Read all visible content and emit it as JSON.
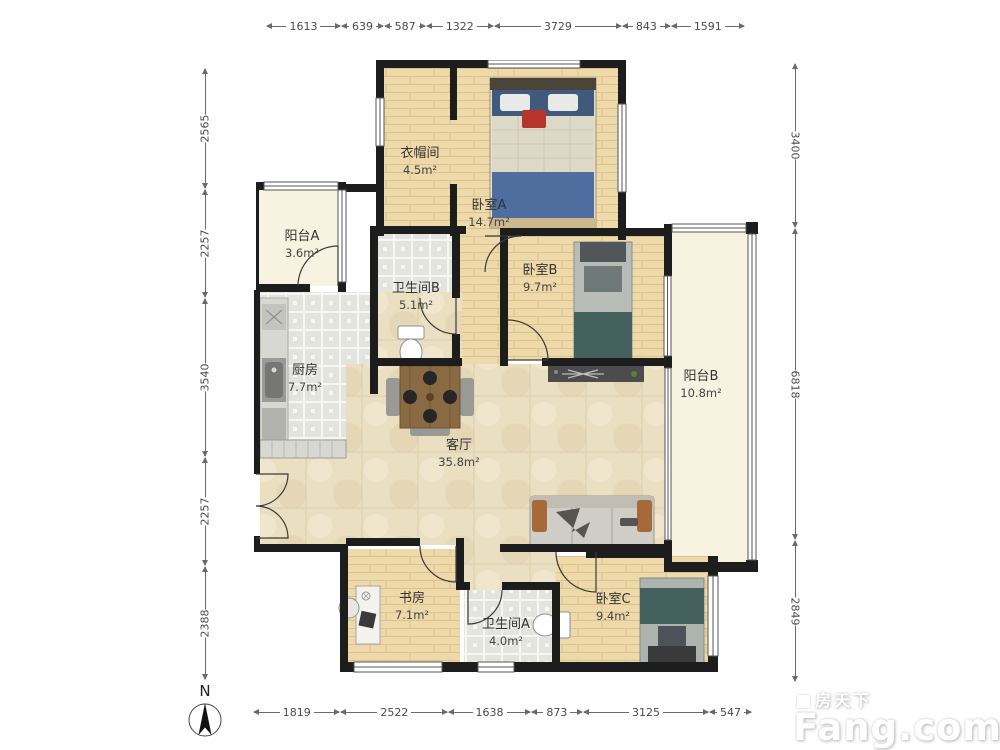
{
  "dims": {
    "top": [
      "1613",
      "639",
      "587",
      "1322",
      "3729",
      "843",
      "1591"
    ],
    "bottom": [
      "1819",
      "2522",
      "1638",
      "873",
      "3125",
      "547"
    ],
    "left": [
      "2565",
      "2257",
      "3540",
      "2257",
      "2388"
    ],
    "right": [
      "3400",
      "6818",
      "2849"
    ]
  },
  "rooms": {
    "cloakroom": {
      "name": "衣帽间",
      "area": "4.5m²"
    },
    "bedroomA": {
      "name": "卧室A",
      "area": "14.7m²"
    },
    "balconyA": {
      "name": "阳台A",
      "area": "3.6m²"
    },
    "bathroomB": {
      "name": "卫生间B",
      "area": "5.1m²"
    },
    "bedroomB": {
      "name": "卧室B",
      "area": "9.7m²"
    },
    "balconyB": {
      "name": "阳台B",
      "area": "10.8m²"
    },
    "kitchen": {
      "name": "厨房",
      "area": "7.7m²"
    },
    "living": {
      "name": "客厅",
      "area": "35.8m²"
    },
    "study": {
      "name": "书房",
      "area": "7.1m²"
    },
    "bathroomA": {
      "name": "卫生间A",
      "area": "4.0m²"
    },
    "bedroomC": {
      "name": "卧室C",
      "area": "9.4m²"
    }
  },
  "compass": {
    "north_label": "N"
  },
  "watermark": {
    "cn": "房天下",
    "en": "Fang.com"
  },
  "colors": {
    "wall": "#1d1d1d",
    "wood_floor": "#eed9aa",
    "tile_floor": "#e4e4df",
    "marble_floor": "#ebdfc2",
    "balcony_floor": "#f8f3e0",
    "dim_text": "#4a4a4a",
    "bed_blue": "#4d6e9e",
    "bed_teal": "#44605c",
    "sofa_accent": "#a66a3a"
  }
}
